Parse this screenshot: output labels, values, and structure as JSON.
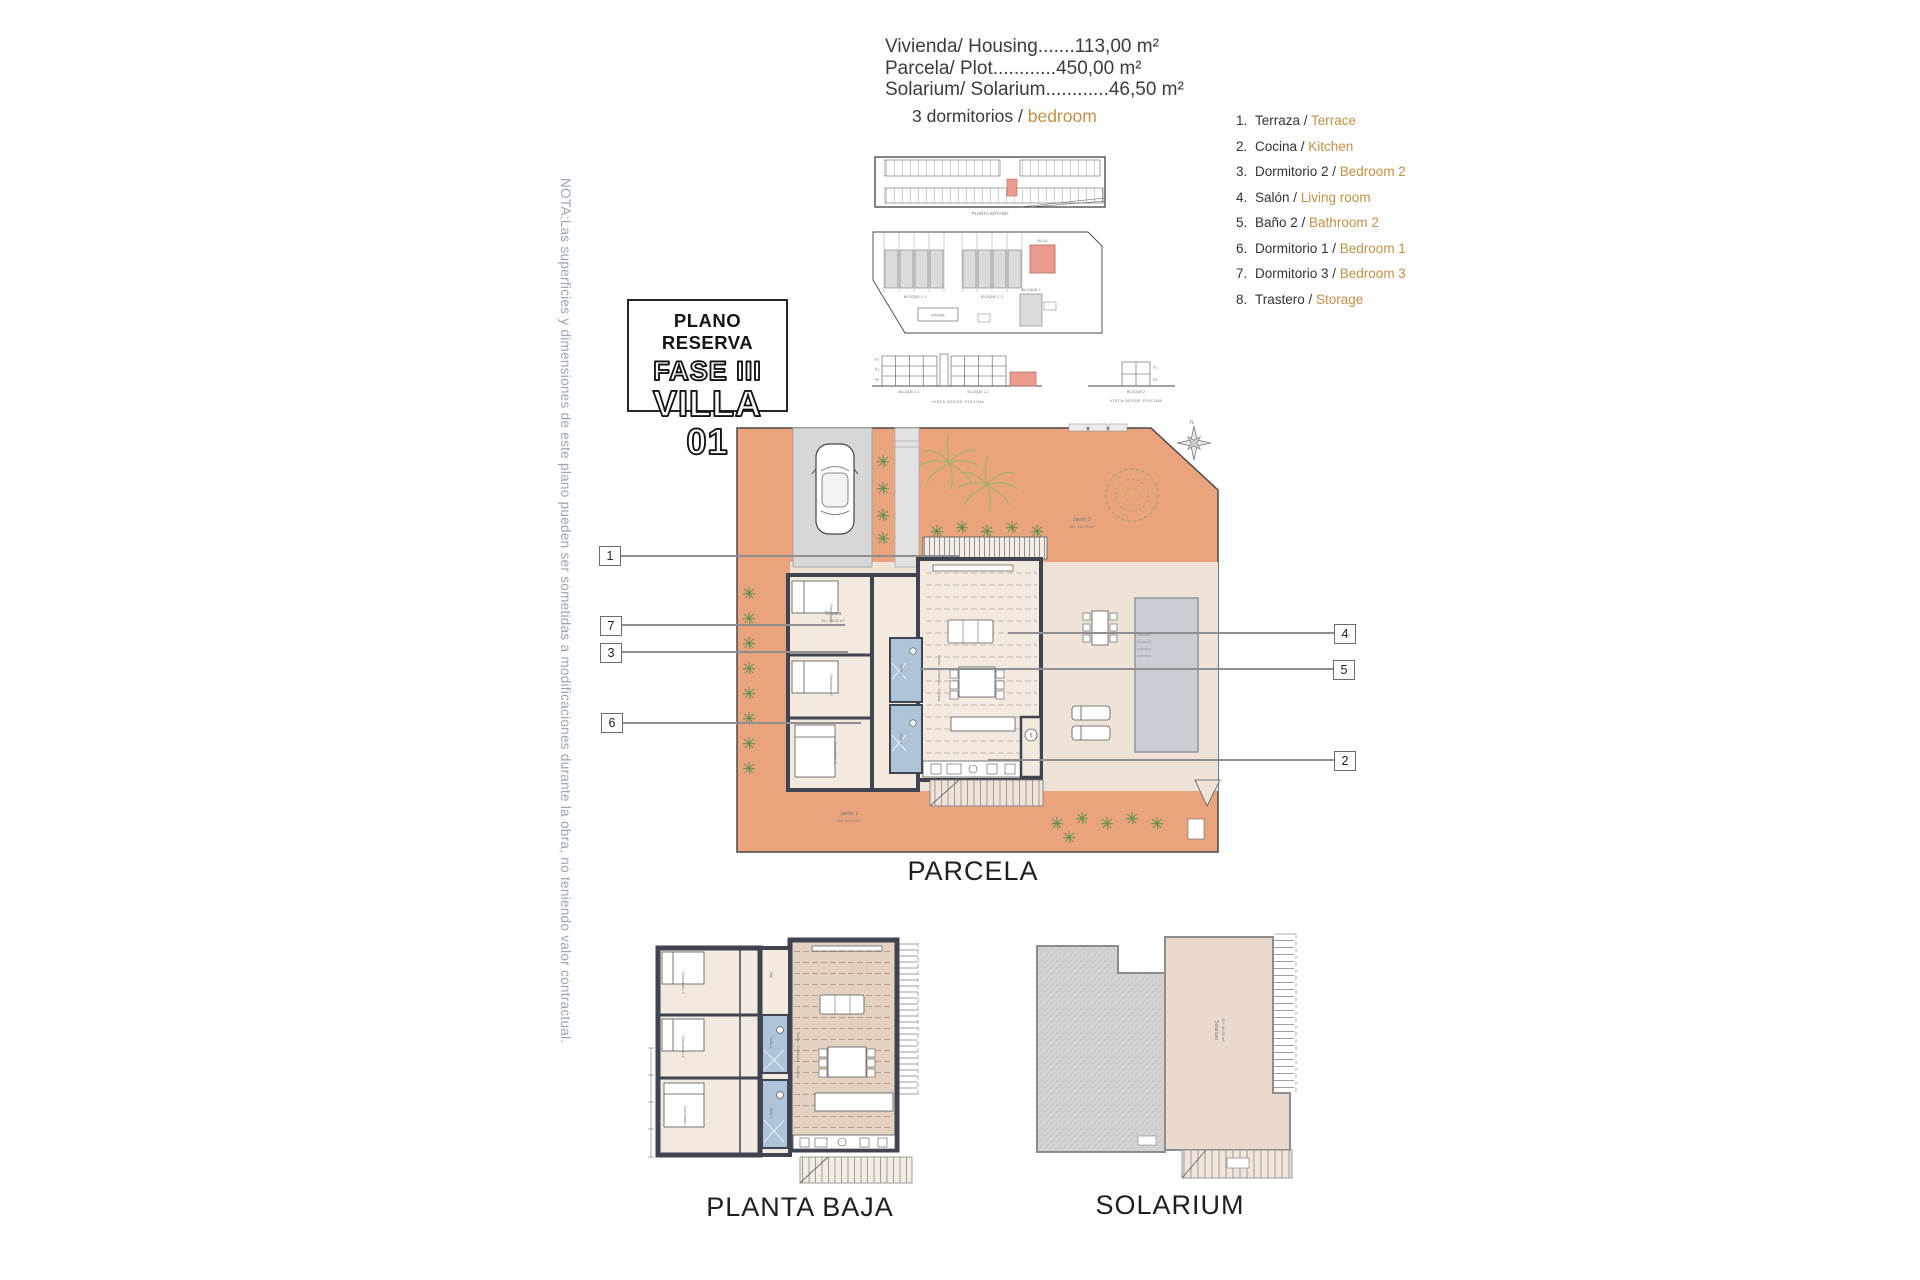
{
  "note": {
    "text": "NOTA:Las superficies y dimensiones de este plano pueden ser sometidas a modificaciones durante la obra, no teniendo valor contractual."
  },
  "specs": {
    "line1": "Vivienda/ Housing.......113,00 m²",
    "line2": "Parcela/ Plot............450,00 m²",
    "line3": "Solarium/ Solarium............46,50 m²"
  },
  "heading": {
    "es": "3 dormitorios / ",
    "en": "bedroom"
  },
  "title_box": {
    "line1": "PLANO RESERVA",
    "line2": "FASE III",
    "line3": "VILLA 01"
  },
  "legend": {
    "items": [
      {
        "num": "1.",
        "es": "Terraza / ",
        "en": "Terrace"
      },
      {
        "num": "2.",
        "es": "Cocina / ",
        "en": "Kitchen"
      },
      {
        "num": "3.",
        "es": "Dormitorio 2 / ",
        "en": "Bedroom 2"
      },
      {
        "num": "4.",
        "es": "Salón / ",
        "en": "Living room"
      },
      {
        "num": "5.",
        "es": "Baño 2 / ",
        "en": "Bathroom 2"
      },
      {
        "num": "6.",
        "es": "Dormitorio 1 / ",
        "en": "Bedroom 1"
      },
      {
        "num": "7.",
        "es": "Dormitorio 3 / ",
        "en": "Bedroom 3"
      },
      {
        "num": "8.",
        "es": "Trastero / ",
        "en": "Storage"
      }
    ]
  },
  "site": {
    "planta_sotano": "PLANTA SÓTANO",
    "bloque11": "BLOQUE 1.1",
    "bloque12": "BLOQUE 1.2",
    "bloque2": "BLOQUE 2",
    "villa": "VILLA",
    "piscina": "PISCINA",
    "vista": "VISTA DESDE PISCINA",
    "p0": "P0",
    "p1": "P1",
    "p2": "P2"
  },
  "parcela": {
    "label": "PARCELA",
    "terraza": "Terraza",
    "terraza_area": "SU: 55,00 m²",
    "jardin2": "Jardín 2",
    "jardin2_area": "SU: 111,00 m²",
    "jardin1": "Jardín 1",
    "jardin1_area": "SU: 62,00 m²",
    "salon": "Salón - Comedor - Cocina",
    "dorm1": "Dormitorio 1",
    "dorm2": "Dormitorio 2",
    "dorm3": "Dormitorio 3",
    "bano1": "Baño 1",
    "bano2": "Baño 2",
    "storage_num": "8",
    "compass_n": "N"
  },
  "planta_baja": {
    "label": "PLANTA BAJA",
    "salon": "Salón - Comedor - Cocina",
    "dorm1": "Dormitorio 1",
    "dorm2": "Dormitorio 2",
    "dorm3": "Dormitorio 3",
    "bano1": "Baño 1",
    "bano2": "Baño 2",
    "hall": "Hall"
  },
  "solarium": {
    "label": "SOLARIUM",
    "area_label": "Solarium",
    "area_value": "SU: 46,50 m²"
  },
  "callouts": {
    "c1": "1",
    "c2": "2",
    "c3": "3",
    "c4": "4",
    "c5": "5",
    "c6": "6",
    "c7": "7"
  },
  "colors": {
    "terracotta": "#E9A47D",
    "plot_beige": "#EFE3D7",
    "wall_dark": "#3F4450",
    "bath_blue": "#AEC4D8",
    "pool_gray": "#C9CED5",
    "accent_orange": "#C38F46"
  }
}
